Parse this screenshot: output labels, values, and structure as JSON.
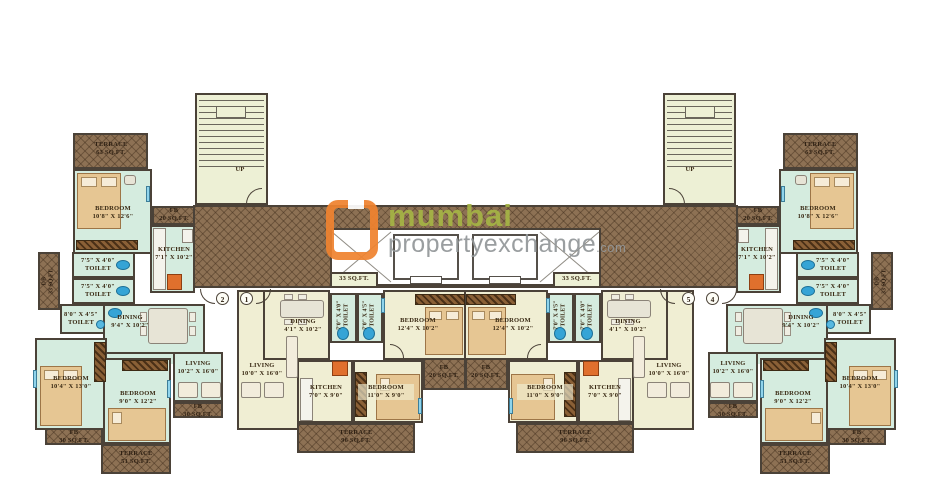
{
  "watermark": {
    "line1": "mumbai",
    "line2": "propertyexchange",
    "suffix": ".com"
  },
  "stairs": {
    "up_label": "UP"
  },
  "unit_markers": {
    "u1": "1",
    "u2": "2",
    "u4": "4",
    "u5": "5"
  },
  "rooms": {
    "terrace63": {
      "name": "TERRACE",
      "dims": "63 SQ.FT."
    },
    "bedroom_a": {
      "name": "BEDROOM",
      "dims": "10'8\" X 12'6\""
    },
    "fb20": {
      "name": "FB",
      "dims": "20 SQ.FT."
    },
    "kitchen_a": {
      "name": "KITCHEN",
      "dims": "7'1\" X 10'2\""
    },
    "toilet_75": {
      "name": "TOILET",
      "dims": "7'5\" X 4'0\""
    },
    "db33": {
      "name": "DB",
      "dims": "33 SQ.FT."
    },
    "toilet_80": {
      "name": "TOILET",
      "dims": "8'0\" X 4'5\""
    },
    "dining_a": {
      "name": "DINING",
      "dims": "9'4\" X 10'2\""
    },
    "living_a": {
      "name": "LIVING",
      "dims": "10'2\" X 16'0\""
    },
    "fb30": {
      "name": "FB",
      "dims": "30 SQ.FT."
    },
    "bedroom_b": {
      "name": "BEDROOM",
      "dims": "10'4\" X 13'0\""
    },
    "bedroom_c": {
      "name": "BEDROOM",
      "dims": "9'0\" X 12'2\""
    },
    "terrace51": {
      "name": "TERRACE",
      "dims": "51 SQ.FT."
    },
    "lobby33": {
      "dims": "33 SQ.FT."
    },
    "toilet_7040": {
      "name": "TOILET",
      "dims": "7'0\" X 4'0\""
    },
    "toilet_7045": {
      "name": "TOILET",
      "dims": "7'0\" X 4'5\""
    },
    "dining_b": {
      "name": "DINING",
      "dims": "4'1\" X 10'2\""
    },
    "bedroom_d": {
      "name": "BEDROOM",
      "dims": "12'4\" X 10'2\""
    },
    "living_b": {
      "name": "LIVING",
      "dims": "10'0\" X 16'0\""
    },
    "kitchen_b": {
      "name": "KITCHEN",
      "dims": "7'0\" X 9'0\""
    },
    "bedroom_e": {
      "name": "BEDROOM",
      "dims": "11'0\" X 9'0\""
    },
    "terrace96": {
      "name": "TERRACE",
      "dims": "96 SQ.FT."
    }
  },
  "palette": {
    "wall": "#4b4238",
    "unit_outer_floor": "#d5ecdf",
    "unit_middle_floor": "#f0eed3",
    "corridor_brown": "#8d7154",
    "fixture_blue": "#35a4d6",
    "stove_orange": "#e0702d",
    "brand_orange": "#ef8330",
    "brand_green": "#a5b445",
    "brand_gray": "#939799"
  }
}
